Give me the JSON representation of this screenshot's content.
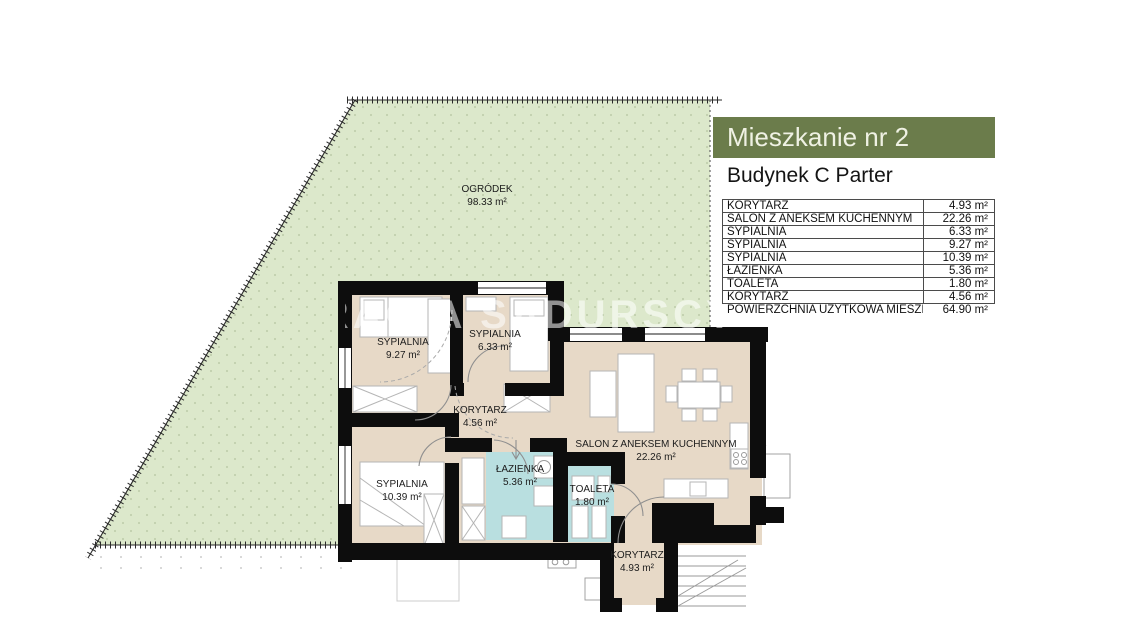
{
  "panel": {
    "title": "Mieszkanie nr 2",
    "subtitle": "Budynek C Parter",
    "accent_color": "#6b7c4b",
    "rooms_table": {
      "rows": [
        {
          "name": "KORYTARZ",
          "area": "4.93 m²"
        },
        {
          "name": "SALON Z ANEKSEM KUCHENNYM",
          "area": "22.26 m²"
        },
        {
          "name": "SYPIALNIA",
          "area": "6.33 m²"
        },
        {
          "name": "SYPIALNIA",
          "area": "9.27 m²"
        },
        {
          "name": "SYPIALNIA",
          "area": "10.39 m²"
        },
        {
          "name": "ŁAZIENKA",
          "area": "5.36 m²"
        },
        {
          "name": "TOALETA",
          "area": "1.80 m²"
        },
        {
          "name": "KORYTARZ",
          "area": "4.56 m²"
        }
      ],
      "total": {
        "name": "POWIERZCHNIA UŻYTKOWA MIESZKANIA",
        "area": "64.90 m²"
      }
    }
  },
  "plan": {
    "watermark": "BRACIA SADURSCY",
    "colors": {
      "garden": "#dce8cb",
      "floor": "#e7d9c7",
      "wet_room": "#b9dfe0",
      "wall": "#0d0d0d"
    },
    "garden": {
      "name": "OGRÓDEK",
      "area": "98.33 m²"
    },
    "rooms": [
      {
        "id": "sypialnia-9-27",
        "name": "SYPIALNIA",
        "area": "9.27 m²"
      },
      {
        "id": "sypialnia-6-33",
        "name": "SYPIALNIA",
        "area": "6.33 m²"
      },
      {
        "id": "korytarz-4-56",
        "name": "KORYTARZ",
        "area": "4.56 m²"
      },
      {
        "id": "salon",
        "name": "SALON Z ANEKSEM KUCHENNYM",
        "area": "22.26 m²"
      },
      {
        "id": "sypialnia-10-39",
        "name": "SYPIALNIA",
        "area": "10.39 m²"
      },
      {
        "id": "lazienka",
        "name": "ŁAZIENKA",
        "area": "5.36 m²"
      },
      {
        "id": "toaleta",
        "name": "TOALETA",
        "area": "1.80 m²"
      },
      {
        "id": "korytarz-4-93",
        "name": "KORYTARZ",
        "area": "4.93 m²"
      }
    ]
  }
}
